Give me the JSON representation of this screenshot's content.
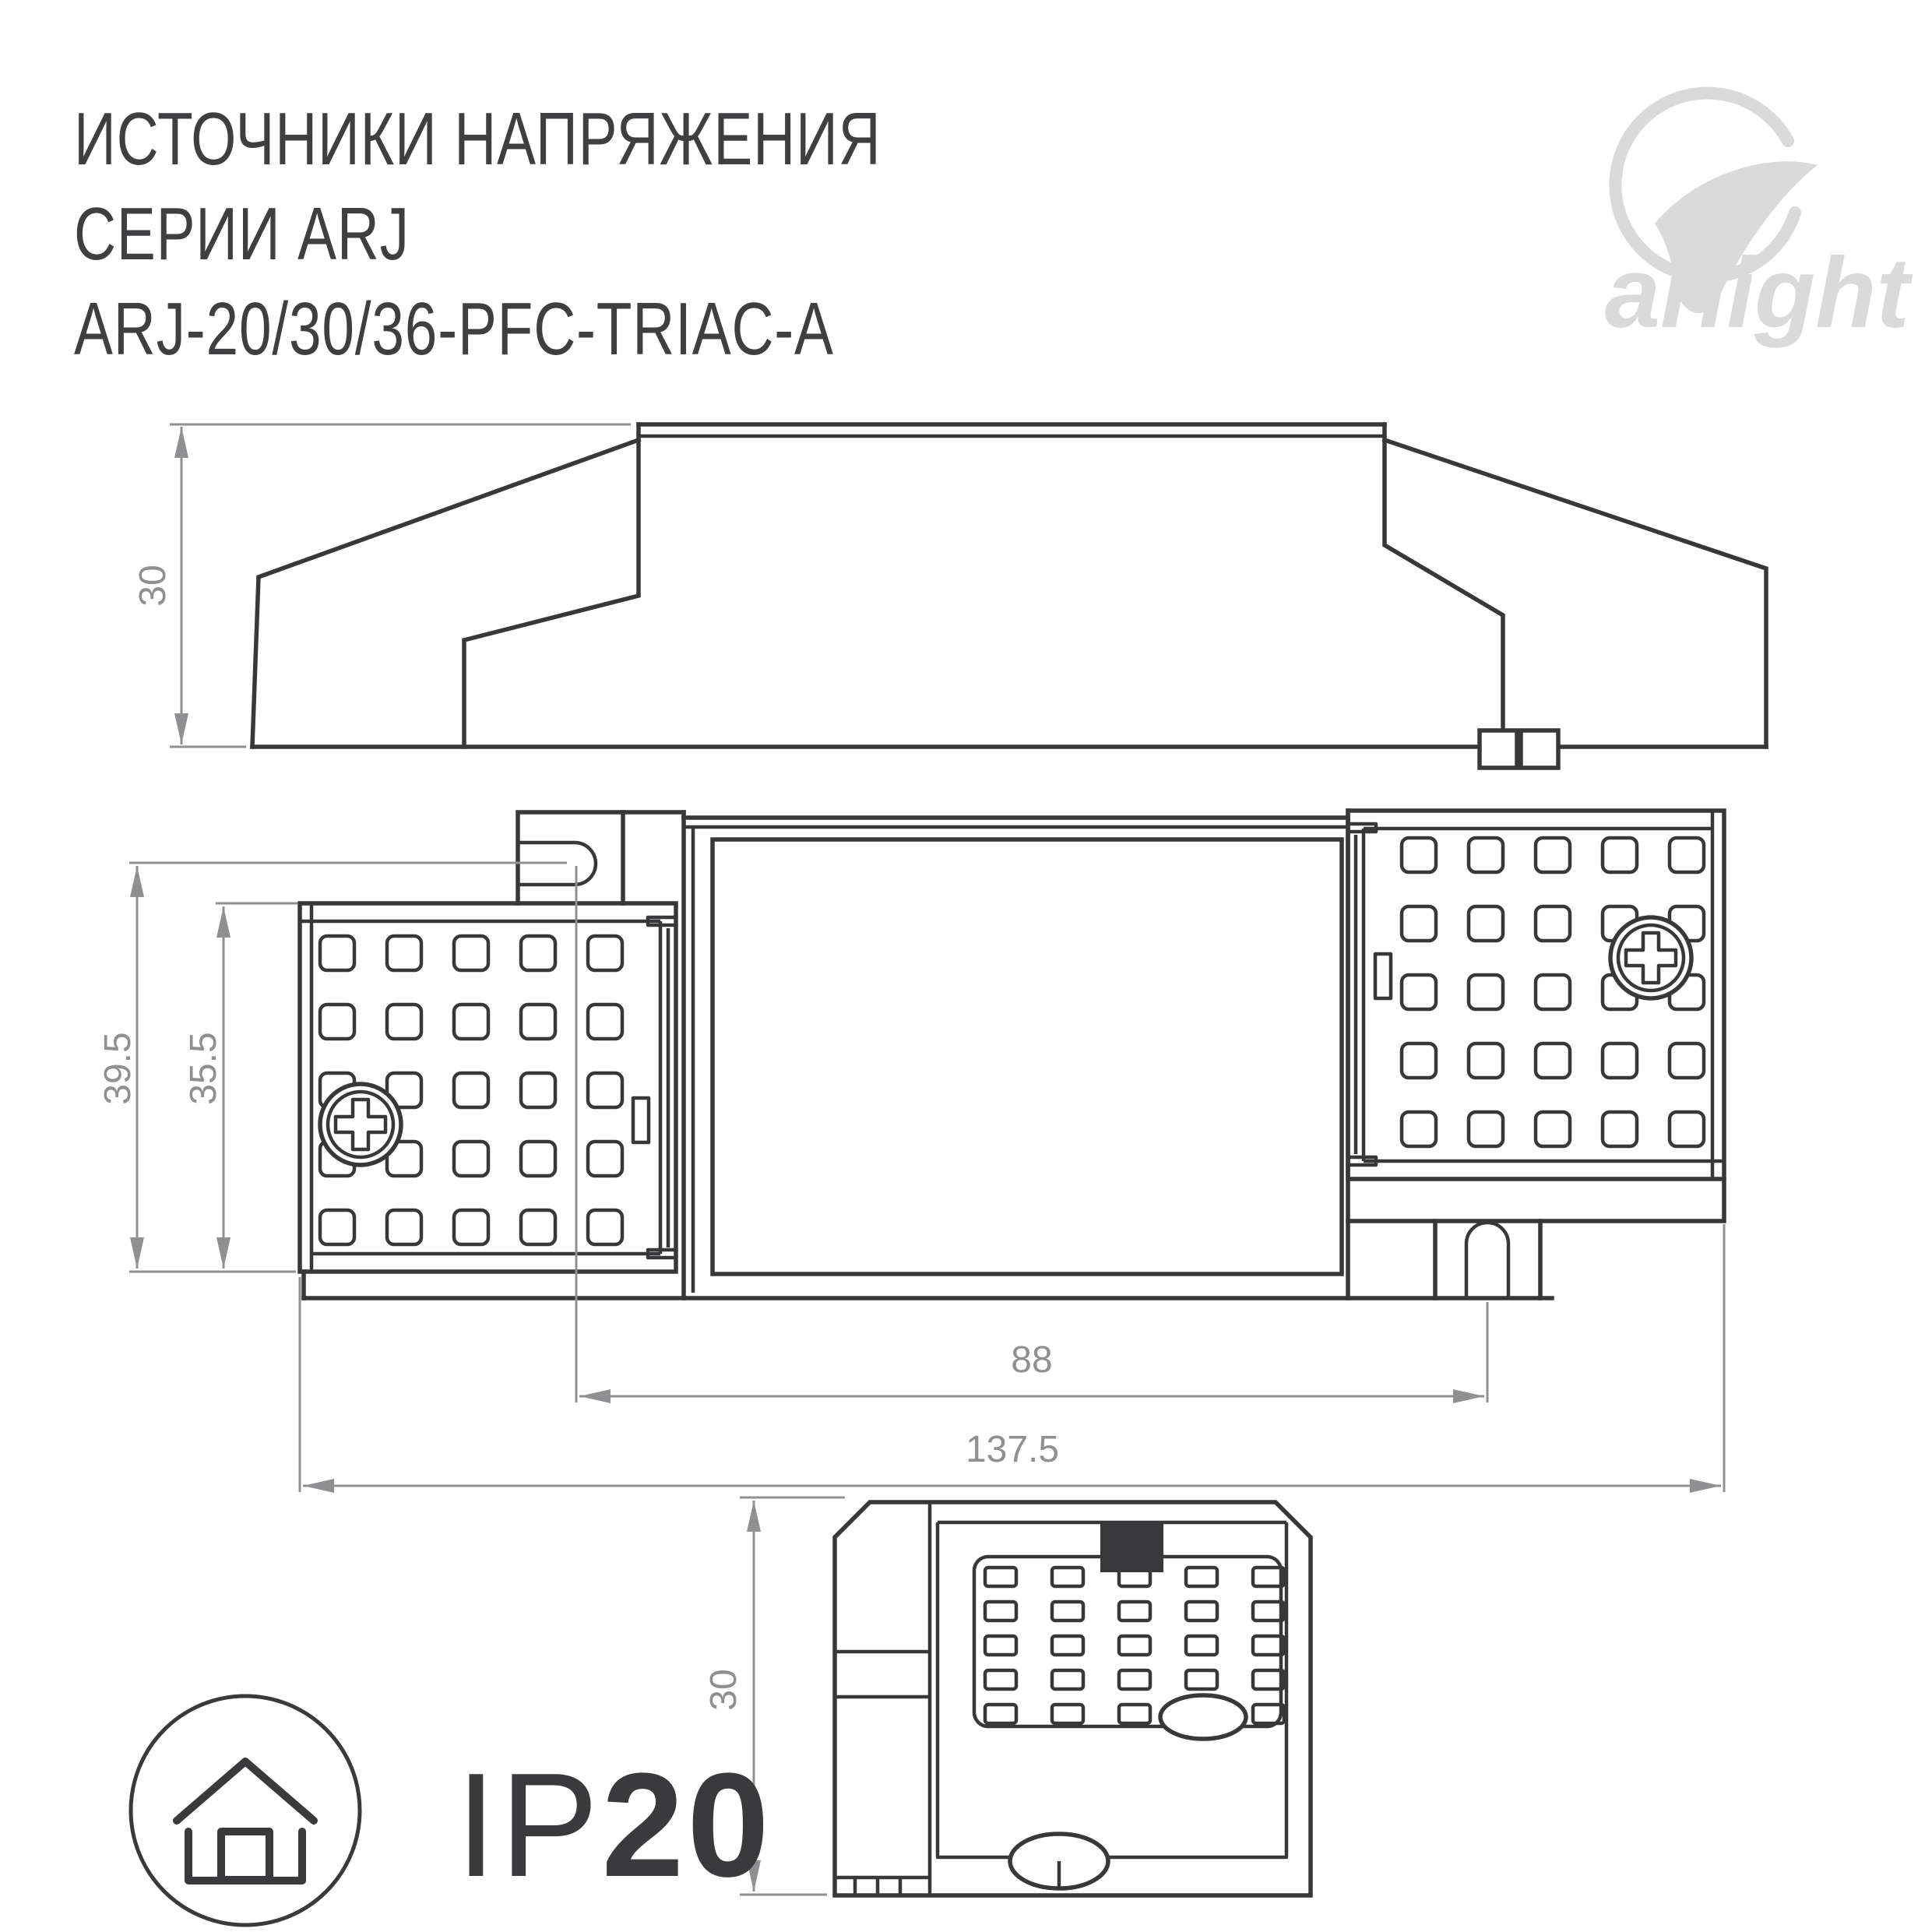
{
  "title": {
    "line1": "ИСТОЧНИКИ НАПРЯЖЕНИЯ",
    "line2": "СЕРИИ ARJ",
    "line3": "ARJ-20/30/36-PFC-TRIAC-A"
  },
  "logo": {
    "text": "arlight",
    "mark": "arlight-swoosh-icon"
  },
  "views": {
    "side": {
      "label": "side-view",
      "height_dim": "30"
    },
    "plan": {
      "label": "top-view",
      "overall_height": "39.5",
      "case_height": "35.5",
      "hole_spacing": "88",
      "overall_length": "137.5"
    },
    "front": {
      "label": "front-view",
      "depth_dim": "30"
    }
  },
  "badge": {
    "ip_prefix": "IP",
    "ip_value": "20",
    "icon": "house-indoor-icon"
  },
  "colors": {
    "line": "#38383a",
    "dimension": "#909092",
    "logo": "#dadadb",
    "background": "#ffffff"
  }
}
